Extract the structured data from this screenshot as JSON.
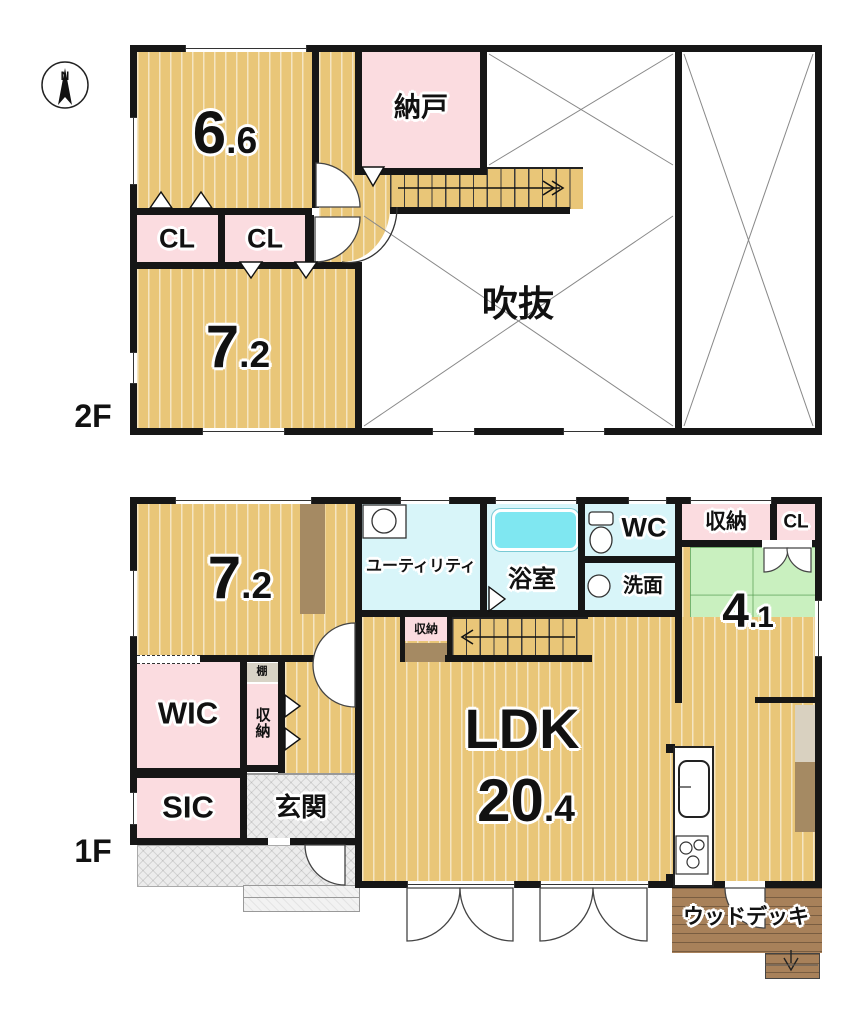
{
  "compass": {
    "north": "N"
  },
  "floor2": {
    "label": "2F",
    "room_66": {
      "whole": "6",
      "frac": ".6"
    },
    "nando": "納戸",
    "cl_left": "CL",
    "cl_right": "CL",
    "room_72": {
      "whole": "7",
      "frac": ".2"
    },
    "void": "吹抜"
  },
  "floor1": {
    "label": "1F",
    "room_72": {
      "whole": "7",
      "frac": ".2"
    },
    "utility": "ユーティリティ",
    "bath": "浴室",
    "wc": "WC",
    "washroom": "洗面",
    "storage_north": "収納",
    "cl": "CL",
    "room_41": {
      "whole": "4",
      "frac": ".1"
    },
    "wic": "WIC",
    "shelf": "棚",
    "storage_hall": "収納",
    "storage_stairs": "収納",
    "sic": "SIC",
    "genkan": "玄関",
    "ldk": {
      "name": "LDK",
      "whole": "20",
      "frac": ".4"
    },
    "wood_deck": "ウッドデッキ"
  },
  "colors": {
    "wall": "#161616",
    "wood": "#e9c678",
    "pink": "#fbdce0",
    "aqua": "#d8f5f9",
    "tub": "#7fe7f1",
    "green": "#c9f0bf",
    "deck": "#a8815a",
    "brown": "#a58a63",
    "beige": "#d9d1c0",
    "shelf": "#d8d3c6",
    "porch": "#ececec"
  }
}
